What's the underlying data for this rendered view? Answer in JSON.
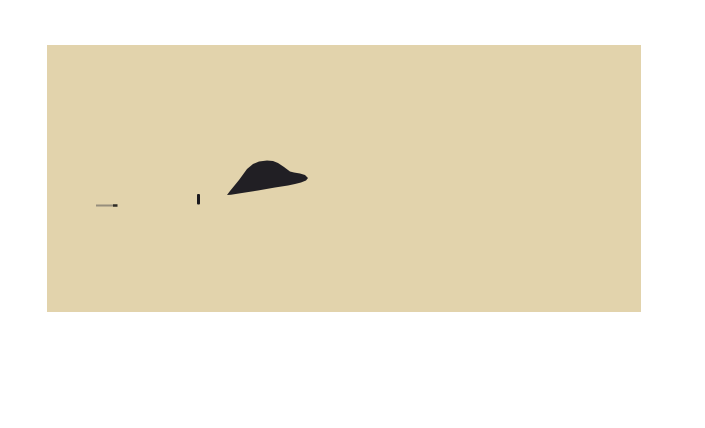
{
  "page": {
    "width": 705,
    "height": 428,
    "background": "#ffffff"
  },
  "scene": {
    "alt_text": "Minimalist desert photograph: uniform sand-colored field with a dark low rock outcrop, a tiny standing figure, and a small stick-like shadow on the ground",
    "photo": {
      "left": 47,
      "top": 45,
      "width": 594,
      "height": 267,
      "sand_color": "#e2d3ac"
    },
    "elements": [
      {
        "name": "rock-formation",
        "type": "polygon",
        "fill": "#211f24",
        "points": "227,195 230,191 239,180 247,169 253,164 259,161.5 267,160.5 273,161 278,163 284,167 290,171.5 294,172.5 300,173.5 305,175 308,178 306,180.5 301,182.5 295,184 288,185.5 275,187.5 258,190.5 242,193 231,194.8"
      },
      {
        "name": "standing-figure",
        "type": "rect",
        "x": 197,
        "y": 194,
        "width": 3,
        "height": 10.5,
        "rx": 1,
        "fill": "#1b191e"
      },
      {
        "name": "ground-stick-body",
        "type": "line",
        "x1": 96,
        "y1": 205.5,
        "x2": 113,
        "y2": 205.5,
        "stroke": "#968e7c",
        "stroke_width": 2
      },
      {
        "name": "ground-stick-tip",
        "type": "line",
        "x1": 113,
        "y1": 205.5,
        "x2": 117.5,
        "y2": 205.5,
        "stroke": "#2e2b26",
        "stroke_width": 2.5
      }
    ]
  }
}
